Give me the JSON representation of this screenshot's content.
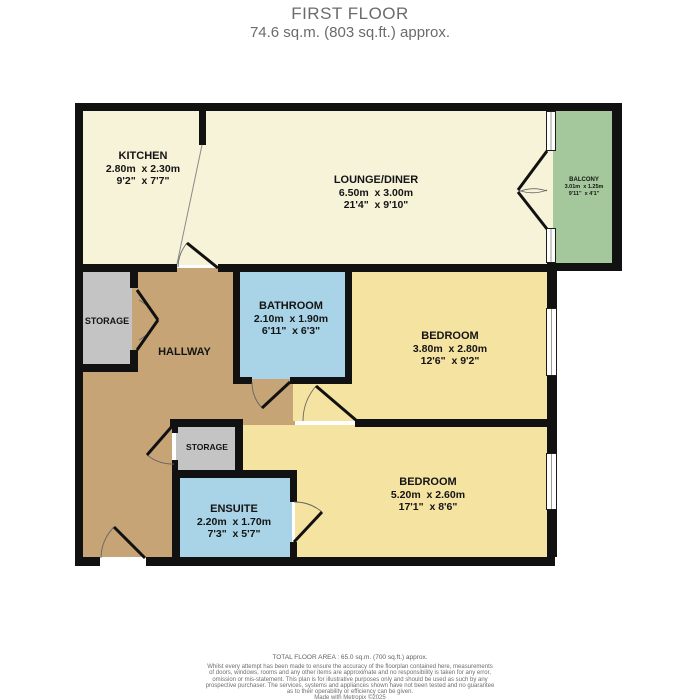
{
  "header": {
    "title": "FIRST FLOOR",
    "subtitle": "74.6 sq.m. (803 sq.ft.) approx."
  },
  "rooms": {
    "kitchen": {
      "name": "KITCHEN",
      "metric": "2.80m  x 2.30m",
      "imperial": "9'2\"  x 7'7\""
    },
    "lounge": {
      "name": "LOUNGE/DINER",
      "metric": "6.50m  x 3.00m",
      "imperial": "21'4\"  x 9'10\""
    },
    "balcony": {
      "name": "BALCONY",
      "metric": "3.01m  x 1.25m",
      "imperial": "9'11\"  x 4'1\""
    },
    "storage1": {
      "name": "STORAGE"
    },
    "hallway": {
      "name": "HALLWAY"
    },
    "bathroom": {
      "name": "BATHROOM",
      "metric": "2.10m  x 1.90m",
      "imperial": "6'11\"  x 6'3\""
    },
    "bedroom1": {
      "name": "BEDROOM",
      "metric": "3.80m  x 2.80m",
      "imperial": "12'6\"  x 9'2\""
    },
    "storage2": {
      "name": "STORAGE"
    },
    "ensuite": {
      "name": "ENSUITE",
      "metric": "2.20m  x 1.70m",
      "imperial": "7'3\"  x 5'7\""
    },
    "bedroom2": {
      "name": "BEDROOM",
      "metric": "5.20m  x 2.60m",
      "imperial": "17'1\"  x 8'6\""
    }
  },
  "footer": {
    "total_area": "TOTAL FLOOR AREA : 65.0 sq.m. (700 sq.ft.) approx.",
    "disclaimer": [
      "Whilst every attempt has been made to ensure the accuracy of the floorplan contained here, measurements",
      "of doors, windows, rooms and any other items are approximate and no responsibility is taken for any error,",
      "omission or mis-statement. This plan is for illustrative purposes only and should be used as such by any",
      "prospective purchaser. The services, systems and appliances shown have not been tested and no guarantee",
      "as to their operability or efficiency can be given.",
      "Made with Metropix ©2025"
    ]
  },
  "colors": {
    "wall": "#111111",
    "kitchen_lounge": "#f7f3d9",
    "bedroom": "#f5e3a2",
    "bathroom_ensuite": "#a9d3e6",
    "hallway": "#c7a476",
    "storage": "#c4c4c4",
    "balcony": "#a4c89c"
  }
}
